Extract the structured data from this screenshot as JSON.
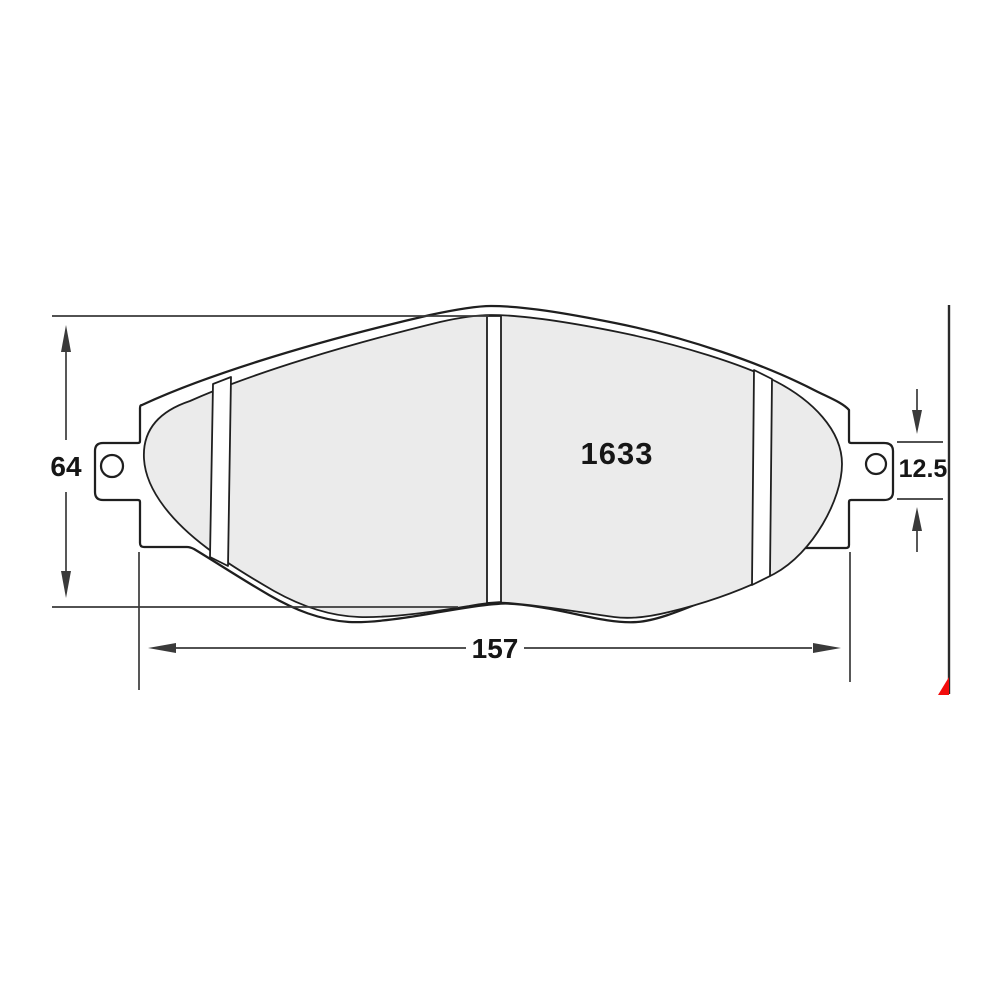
{
  "page": {
    "background": "#ffffff"
  },
  "diagram": {
    "type": "brake-pad-dimension-drawing",
    "part_number": "1633",
    "dimensions": {
      "overall_height": "64",
      "overall_length": "157",
      "tab_height": "12.5"
    },
    "colors": {
      "friction_fill": "#ebebeb",
      "plate_fill": "#ffffff",
      "outline": "#1f1f1f",
      "dimension_lines": "#3a3a3a",
      "label_text": "#161616",
      "accent_red": "#f20d0d"
    }
  }
}
